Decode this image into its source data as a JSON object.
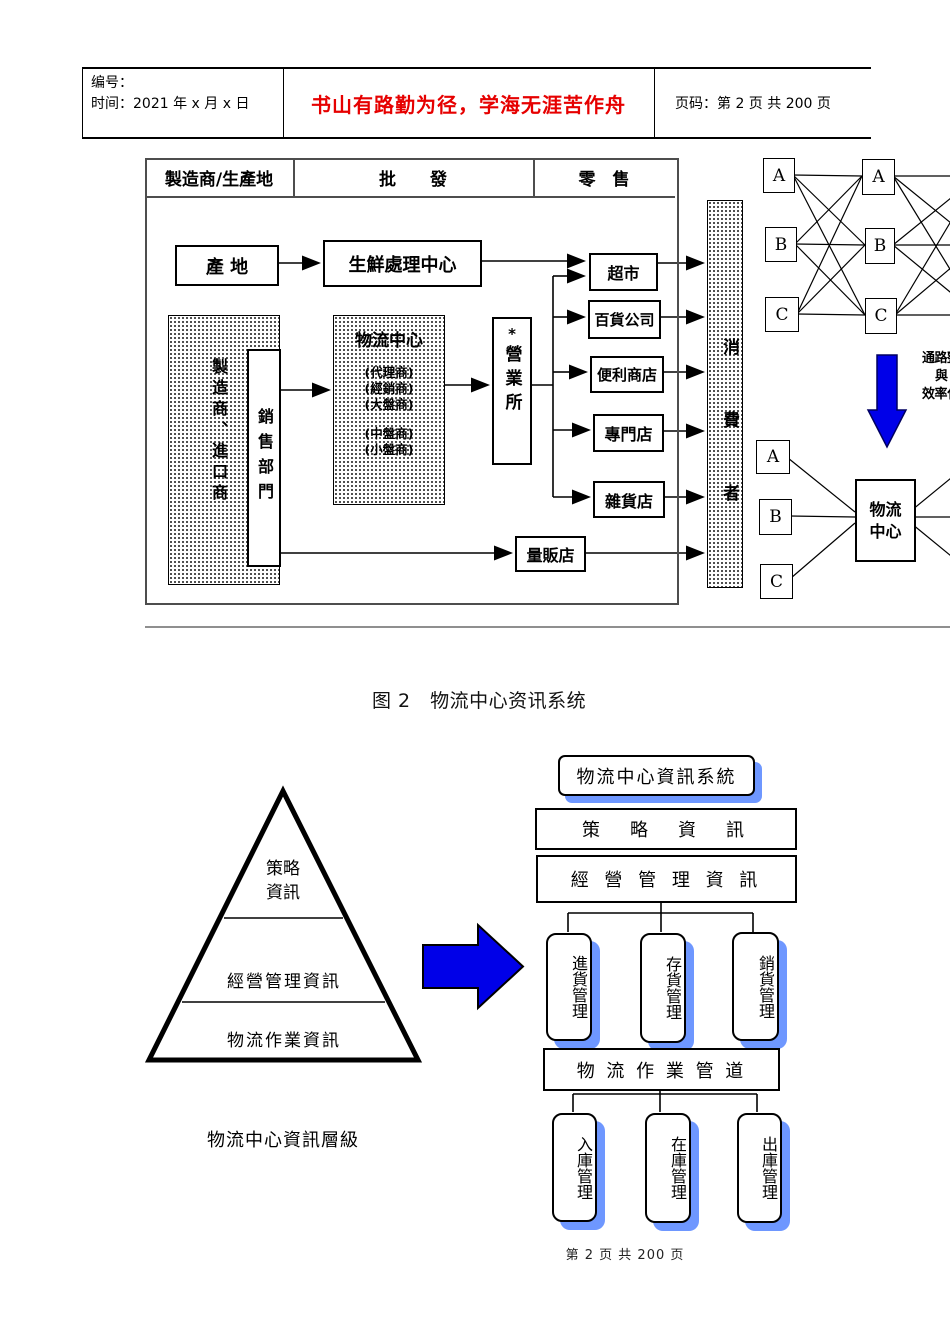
{
  "header": {
    "no_label": "编号：",
    "date_label": "时间：2021 年 x 月 x 日",
    "motto": "书山有路勤为径，学海无涯苦作舟",
    "page_label": "页码：第 2 页  共 200 页"
  },
  "flow": {
    "columns": [
      "製造商/生產地",
      "批　　發",
      "零　售"
    ],
    "origin": "產 地",
    "fresh_center": "生鮮處理中心",
    "maker": "製造商、進口商",
    "sales": "銷售部門",
    "dc_title": "物流中心",
    "dc_sub1": [
      "(代理商)",
      "(經銷商)",
      "(大盤商)"
    ],
    "dc_sub2": [
      "(中盤商)",
      "(小盤商)"
    ],
    "office_mark": "*",
    "office": "營業所",
    "stores": [
      "超市",
      "百貨公司",
      "便利商店",
      "專門店",
      "雜貨店"
    ],
    "hyper": "量販店",
    "consumer": "消費者"
  },
  "network": {
    "top_left": [
      "A",
      "B",
      "C"
    ],
    "top_right": [
      "A",
      "B",
      "C"
    ],
    "bottom": [
      "A",
      "B",
      "C"
    ],
    "dc_line1": "物流",
    "dc_line2": "中心",
    "note_lines": [
      "通路整",
      "與",
      "效率化"
    ]
  },
  "figure_caption": "图 2　物流中心资讯系统",
  "pyramid": {
    "top1": "策略",
    "top2": "資訊",
    "mid": "經營管理資訊",
    "bottom": "物流作業資訊",
    "caption": "物流中心資訊層級"
  },
  "hierarchy": {
    "root": "物流中心資訊系統",
    "strategy": "策　略　資　訊",
    "management": "經 營 管 理 資 訊",
    "row1": [
      "進貨管理",
      "存貨管理",
      "銷貨管理"
    ],
    "pipeline": "物 流 作 業 管 道",
    "row2": [
      "入庫管理",
      "在庫管理",
      "出庫管理"
    ]
  },
  "footer": {
    "page_text": "第 2 页 共 200 页"
  },
  "colors": {
    "motto_red": "#e60000",
    "arrow_blue": "#0000e8",
    "shadow_blue": "#6e97ff"
  }
}
